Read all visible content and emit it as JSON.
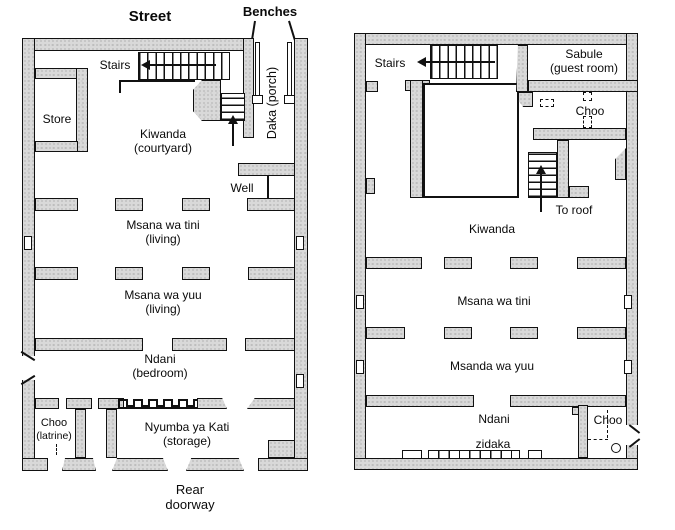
{
  "colors": {
    "background": "#ffffff",
    "wall_fill": "#d9d9d9",
    "line": "#111111",
    "text": "#0a0a0a"
  },
  "left_plan": {
    "street": "Street",
    "benches": "Benches",
    "stairs": "Stairs",
    "store": "Store",
    "kiwanda": "Kiwanda",
    "kiwanda_sub": "(courtyard)",
    "daka": "Daka (porch)",
    "well": "Well",
    "msana_wa_tini": "Msana wa tini",
    "msana_wa_tini_sub": "(living)",
    "msana_wa_yuu": "Msana wa yuu",
    "msana_wa_yuu_sub": "(living)",
    "ndani": "Ndani",
    "ndani_sub": "(bedroom)",
    "choo": "Choo",
    "choo_sub": "(latrine)",
    "nyumba_ya_kati": "Nyumba ya Kati",
    "nyumba_ya_kati_sub": "(storage)",
    "rear_line1": "Rear",
    "rear_line2": "doorway"
  },
  "right_plan": {
    "stairs": "Stairs",
    "sabule": "Sabule",
    "sabule_sub": "(guest room)",
    "choo_upper": "Choo",
    "to_roof": "To roof",
    "kiwanda": "Kiwanda",
    "msana_wa_tini": "Msana wa tini",
    "msanda_wa_yuu": "Msanda wa yuu",
    "ndani": "Ndani",
    "zidaka": "zidaka",
    "choo_lower": "Choo"
  }
}
